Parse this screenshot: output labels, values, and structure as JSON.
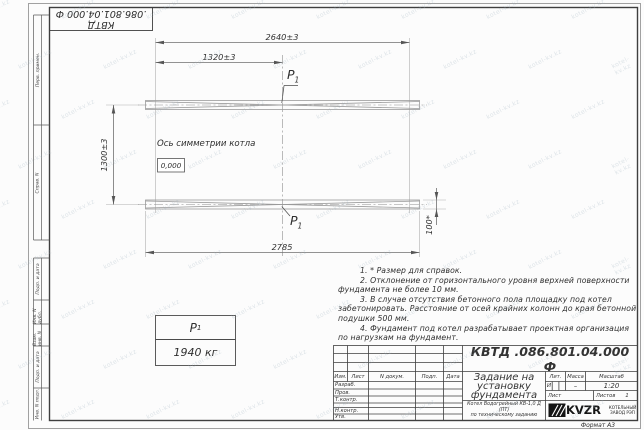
{
  "colors": {
    "frame": "#3f3f3f",
    "line": "#6f6f6f",
    "beam": "#9a9a9a",
    "text": "#2f2f2f",
    "watermark": "#9db0bd"
  },
  "watermark": {
    "text": "kotel-kv.kz"
  },
  "stamp": {
    "designation": "КВТД .086.801.04.000  Ф"
  },
  "side_strip": {
    "labels": [
      "Перв. примен.",
      "Справ. N",
      "Подп. и дата",
      "Инв. N дубл.",
      "Взам. инв. N",
      "Подп. и дата",
      "Инв. N подл."
    ]
  },
  "drawing": {
    "dim_top": "2640±3",
    "dim_half": "1320±3",
    "dim_height": "1300±3",
    "dim_bottom": "2785",
    "dim_beam_height": "100*",
    "axis_label": "Ось симметрии котла",
    "level_mark": "0,000",
    "load_point": {
      "symbol": "P",
      "sub": "1"
    },
    "load_table": {
      "symbol": "P",
      "sub": "1",
      "value": "1940 кг"
    }
  },
  "notes": {
    "lines": [
      {
        "text": "1. * Размер для справок.",
        "indent": true
      },
      {
        "text": "2. Отклонение от горизонтального уровня верхней поверхности",
        "indent": true
      },
      {
        "text": "фундамента не более 10 мм.",
        "indent": false
      },
      {
        "text": "3. В случае отсутствия бетонного пола площадку под котел",
        "indent": true
      },
      {
        "text": "забетонировать. Расстояние от осей крайних колонн до края бетонной",
        "indent": false
      },
      {
        "text": "подушки 500 мм.",
        "indent": false
      },
      {
        "text": "4. Фундамент под котел разрабатывает проектная организация",
        "indent": true
      },
      {
        "text": "по нагрузкам на фундамент.",
        "indent": false
      }
    ]
  },
  "title_block": {
    "designation": "КВТД .086.801.04.000  Ф",
    "doc_title": "Задание на\nустановку\nфундамента",
    "header_cols": [
      "Изм.",
      "Лист",
      "N докум.",
      "Подп.",
      "Дата"
    ],
    "sig_rows": [
      "Разраб.",
      "Пров.",
      "Т.контр.",
      "Н.контр.",
      "Утв."
    ],
    "lit_label": "Лит.",
    "mass_label": "Масса",
    "scale_label": "Масштаб",
    "lit_value": "И",
    "mass_value": "–",
    "scale_value": "1:20",
    "sheet_label": "Лист",
    "sheets_label": "Листов",
    "sheets_value": "1",
    "product": "Котел Водогрейный КВ-1,0 Д (ПТ)\nпо техническому заданию",
    "logo_text": "KVZR",
    "logo_sub": "КОТЕЛЬНЫЙ\nЗАВОД РЭП",
    "format_label": "Формат А3"
  }
}
